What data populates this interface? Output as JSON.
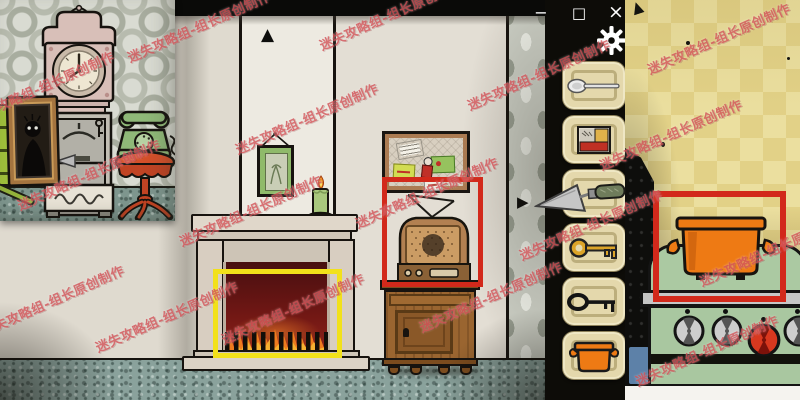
{
  "watermark": {
    "text": "迷失攻略组-组长原创制作",
    "color": "#d4575c"
  },
  "window_controls": {
    "minimize": "−",
    "maximize": "□",
    "close": "×"
  },
  "navigation": {
    "up_arrow": "▲",
    "right_arrow": "▶"
  },
  "inventory": {
    "background": "#0d0c08",
    "slot_color": "#e4d8ac",
    "slots": [
      {
        "item": "spoon"
      },
      {
        "item": "photo"
      },
      {
        "item": "empty"
      },
      {
        "item": "gold-key"
      },
      {
        "item": "black-key"
      },
      {
        "item": "orange-pot"
      }
    ],
    "floating_item": "trowel",
    "settings_icon": "gear"
  },
  "main_scene": {
    "objects": [
      "fireplace",
      "fire",
      "green-candle",
      "framed-picture",
      "bulletin-board",
      "vintage-radio",
      "wooden-cabinet"
    ],
    "highlight_boxes": [
      {
        "color": "#f2e11a",
        "around": "fireplace-fire"
      },
      {
        "color": "#d2291b",
        "around": "radio-and-cabinet"
      }
    ]
  },
  "left_inset": {
    "objects": [
      "grandfather-clock",
      "mirror-with-shadow-figure",
      "coat-hanger",
      "trowel-on-shelf",
      "green-telephone",
      "red-side-table",
      "green-drawers"
    ]
  },
  "right_inset": {
    "objects": [
      "orange-pot-on-stove",
      "green-stove",
      "stove-knobs"
    ],
    "highlight_boxes": [
      {
        "color": "#d2291b",
        "around": "orange-pot"
      }
    ]
  },
  "palette": {
    "highlight_yellow": "#f2e11a",
    "highlight_red": "#d2291b",
    "pot_orange": "#ee7a14",
    "stove_green": "#a9c7a0",
    "wall_beige": "#e3ded4",
    "floor_teal": "#8aa29c",
    "inventory_black": "#0d0c08"
  }
}
